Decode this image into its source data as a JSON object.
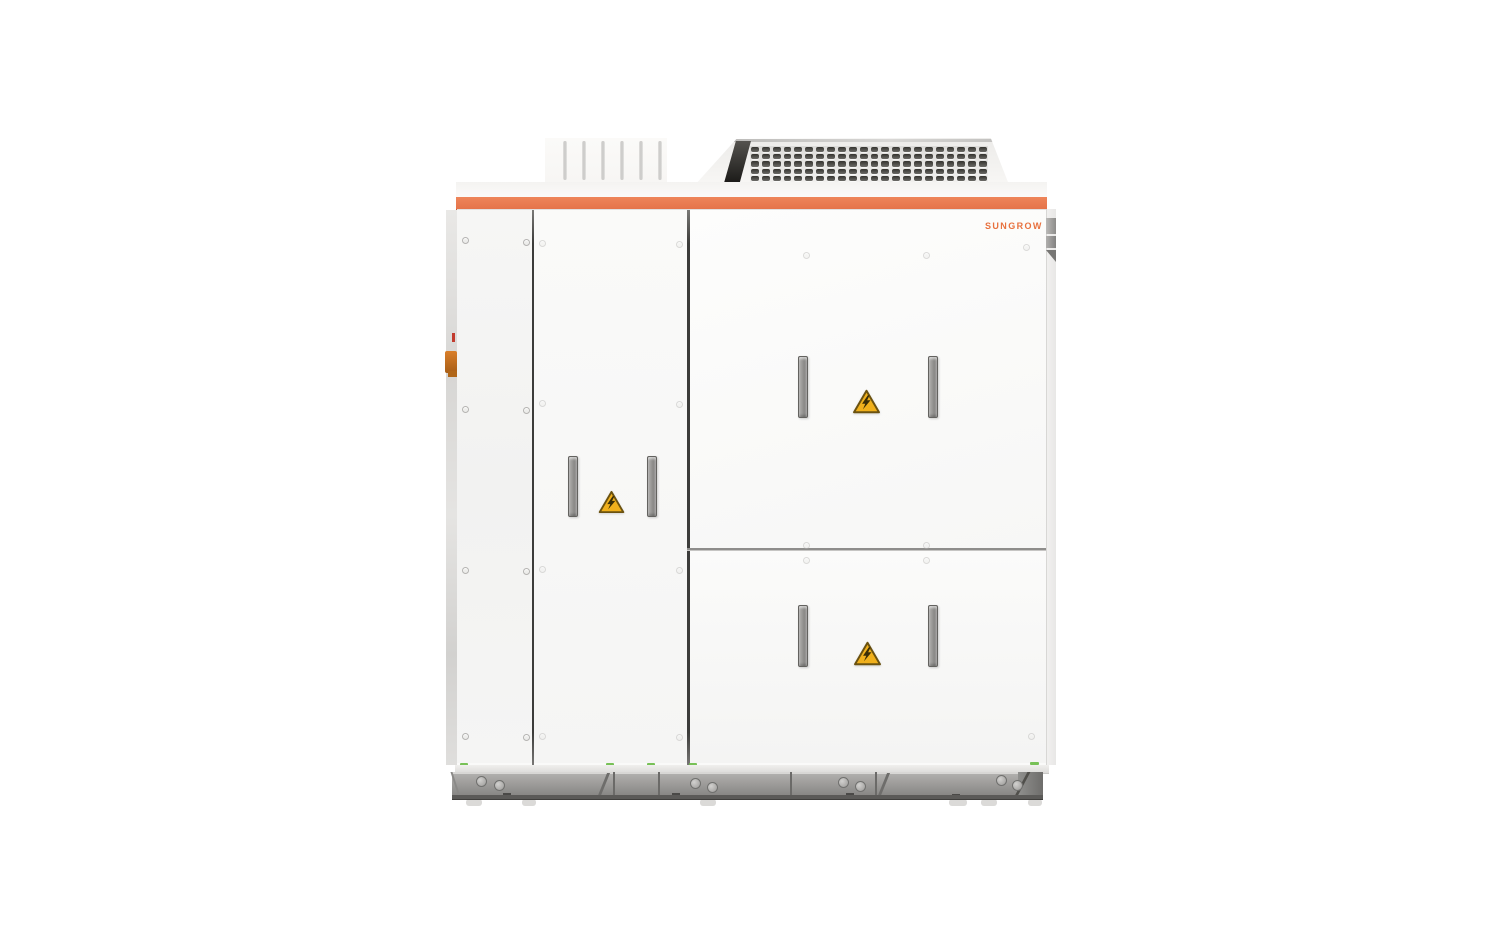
{
  "image": {
    "type": "product-photo",
    "subject": "Outdoor power conversion / energy storage cabinet on a steel skid base",
    "background": "#FFFFFF"
  },
  "brand": {
    "logo_text": "SUNGROW",
    "logo_color": "#E8713E"
  },
  "colors": {
    "accent_stripe": "#E97B50",
    "panel_white": "#FAFAF9",
    "seam_dark": "#3C3C3A",
    "skid_gray": "#969593",
    "warning_yellow": "#F0B01C",
    "warning_border": "#6B5210",
    "ground_marker_green": "#71BE4E"
  },
  "roof": {
    "vent_slot_count": 6,
    "grille": {
      "rows": 5,
      "cols": 22
    }
  },
  "warnings": {
    "count": 3,
    "symbol": "high-voltage-lightning"
  },
  "doors": {
    "handle_count": 6
  }
}
